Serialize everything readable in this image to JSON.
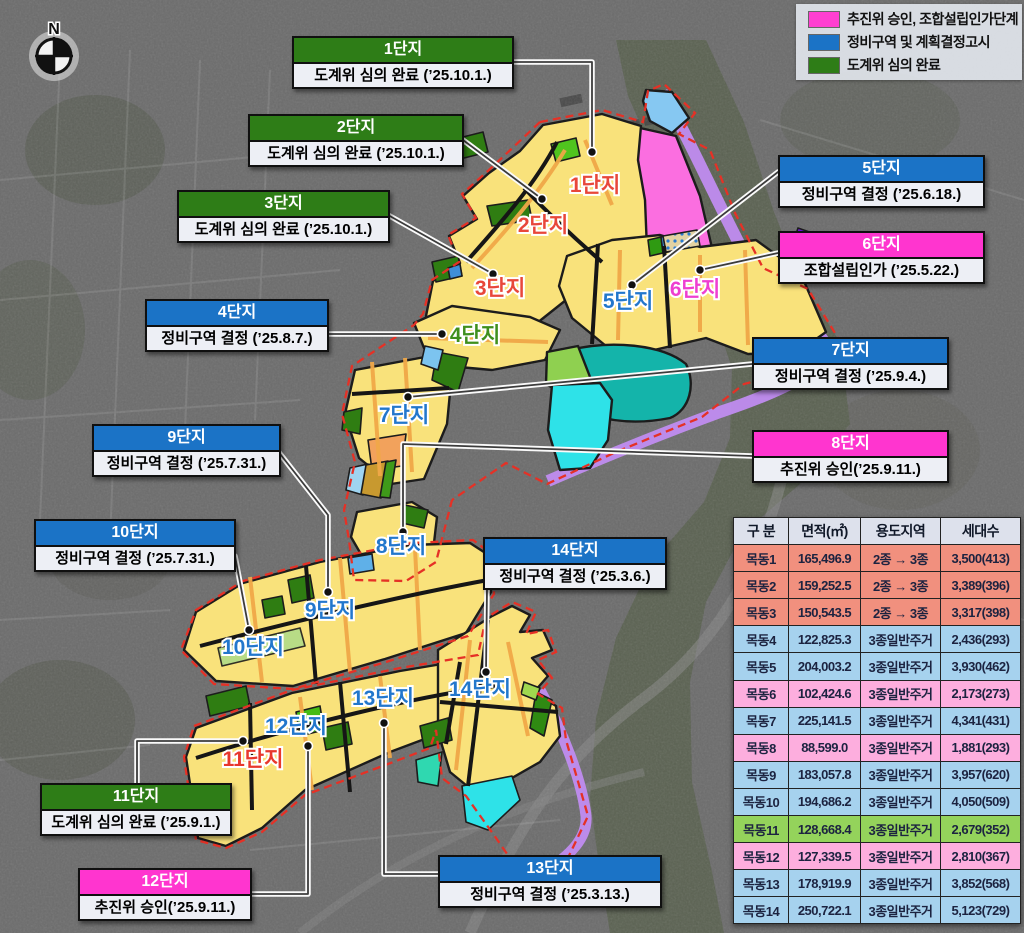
{
  "compass": {
    "label": "N"
  },
  "legend": {
    "items": [
      {
        "label": "추진위 승인, 조합설립인가단계",
        "color": "#ff3fd1"
      },
      {
        "label": "정비구역 및 계획결정고시",
        "color": "#1b73c6"
      },
      {
        "label": "도계위 심의 완료",
        "color": "#2e7d17"
      }
    ]
  },
  "callouts": [
    {
      "title": "1단지",
      "body": "도계위 심의 완료 (’25.10.1.)",
      "status_color": "#2e7d17"
    },
    {
      "title": "2단지",
      "body": "도계위 심의 완료 (’25.10.1.)",
      "status_color": "#2e7d17"
    },
    {
      "title": "3단지",
      "body": "도계위 심의 완료 (’25.10.1.)",
      "status_color": "#2e7d17"
    },
    {
      "title": "4단지",
      "body": "정비구역 결정 (’25.8.7.)",
      "status_color": "#1b73c6"
    },
    {
      "title": "5단지",
      "body": "정비구역 결정 (’25.6.18.)",
      "status_color": "#1b73c6"
    },
    {
      "title": "6단지",
      "body": "조합설립인가 (’25.5.22.)",
      "status_color": "#ff35cf"
    },
    {
      "title": "7단지",
      "body": "정비구역 결정 (’25.9.4.)",
      "status_color": "#1b73c6"
    },
    {
      "title": "8단지",
      "body": "추진위 승인(’25.9.11.)",
      "status_color": "#ff35cf"
    },
    {
      "title": "9단지",
      "body": "정비구역 결정 (’25.7.31.)",
      "status_color": "#1b73c6"
    },
    {
      "title": "10단지",
      "body": "정비구역 결정 (’25.7.31.)",
      "status_color": "#1b73c6"
    },
    {
      "title": "11단지",
      "body": "도계위 심의 완료 (’25.9.1.)",
      "status_color": "#2e7d17"
    },
    {
      "title": "12단지",
      "body": "추진위 승인(’25.9.11.)",
      "status_color": "#ff35cf"
    },
    {
      "title": "13단지",
      "body": "정비구역 결정 (’25.3.13.)",
      "status_color": "#1b73c6"
    },
    {
      "title": "14단지",
      "body": "정비구역 결정  (’25.3.6.)",
      "status_color": "#1b73c6"
    }
  ],
  "map_labels": [
    {
      "text": "1단지",
      "color": "#e8473a"
    },
    {
      "text": "2단지",
      "color": "#e8473a"
    },
    {
      "text": "3단지",
      "color": "#e8473a"
    },
    {
      "text": "4단지",
      "color": "#3f8f1c"
    },
    {
      "text": "5단지",
      "color": "#2277cc"
    },
    {
      "text": "6단지",
      "color": "#ee3fd0"
    },
    {
      "text": "7단지",
      "color": "#2277cc"
    },
    {
      "text": "8단지",
      "color": "#2277cc"
    },
    {
      "text": "9단지",
      "color": "#2277cc"
    },
    {
      "text": "10단지",
      "color": "#2277cc"
    },
    {
      "text": "11단지",
      "color": "#e8382c"
    },
    {
      "text": "12단지",
      "color": "#2277cc"
    },
    {
      "text": "13단지",
      "color": "#2277cc"
    },
    {
      "text": "14단지",
      "color": "#2277cc"
    }
  ],
  "table": {
    "headers": [
      "구 분",
      "면적(㎡)",
      "용도지역",
      "세대수"
    ],
    "rows": [
      {
        "name": "목동1",
        "area": "165,496.9",
        "zone": "2종 → 3종",
        "units": "3,500(413)",
        "status": "review"
      },
      {
        "name": "목동2",
        "area": "159,252.5",
        "zone": "2종 → 3종",
        "units": "3,389(396)",
        "status": "review"
      },
      {
        "name": "목동3",
        "area": "150,543.5",
        "zone": "2종 → 3종",
        "units": "3,317(398)",
        "status": "review"
      },
      {
        "name": "목동4",
        "area": "122,825.3",
        "zone": "3종일반주거",
        "units": "2,436(293)",
        "status": "decision"
      },
      {
        "name": "목동5",
        "area": "204,003.2",
        "zone": "3종일반주거",
        "units": "3,930(462)",
        "status": "decision"
      },
      {
        "name": "목동6",
        "area": "102,424.6",
        "zone": "3종일반주거",
        "units": "2,173(273)",
        "status": "approval"
      },
      {
        "name": "목동7",
        "area": "225,141.5",
        "zone": "3종일반주거",
        "units": "4,341(431)",
        "status": "decision"
      },
      {
        "name": "목동8",
        "area": "88,599.0",
        "zone": "3종일반주거",
        "units": "1,881(293)",
        "status": "approval"
      },
      {
        "name": "목동9",
        "area": "183,057.8",
        "zone": "3종일반주거",
        "units": "3,957(620)",
        "status": "decision"
      },
      {
        "name": "목동10",
        "area": "194,686.2",
        "zone": "3종일반주거",
        "units": "4,050(509)",
        "status": "decision"
      },
      {
        "name": "목동11",
        "area": "128,668.4",
        "zone": "3종일반주거",
        "units": "2,679(352)",
        "status": "review-green"
      },
      {
        "name": "목동12",
        "area": "127,339.5",
        "zone": "3종일반주거",
        "units": "2,810(367)",
        "status": "approval"
      },
      {
        "name": "목동13",
        "area": "178,919.9",
        "zone": "3종일반주거",
        "units": "3,852(568)",
        "status": "decision"
      },
      {
        "name": "목동14",
        "area": "250,722.1",
        "zone": "3종일반주거",
        "units": "5,123(729)",
        "status": "decision"
      }
    ]
  }
}
